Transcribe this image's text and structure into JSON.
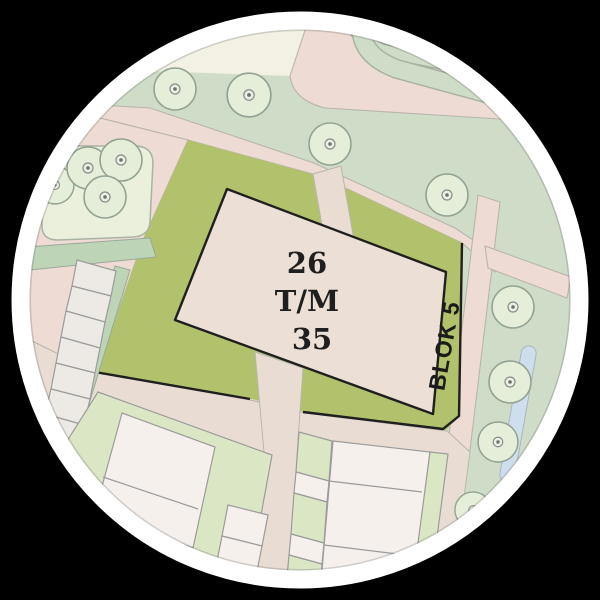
{
  "map": {
    "building_label": {
      "lines": [
        "26",
        "T/M",
        "35"
      ]
    },
    "block_strip_label": "BLOK 5",
    "colors": {
      "background_black": "#000000",
      "ring_white": "#ffffff",
      "olive_green": "#b2c16c",
      "building_beige": "#ecdfd5",
      "sage_green": "#cfddc8",
      "cream": "#f2f1e3",
      "road_pink": "#eddbd4",
      "road_beige": "#e9ddd3",
      "parcel_green": "#dbe7c4",
      "parcel_white": "#f6f0ec",
      "pale_green": "#eaf0dc",
      "strip_green": "#bdd4b7",
      "tree_green": "#e4eed9",
      "water_blue": "#cfdeec",
      "outline_dark": "#1f1f1f",
      "line_gray": "#9b9b9b"
    }
  }
}
